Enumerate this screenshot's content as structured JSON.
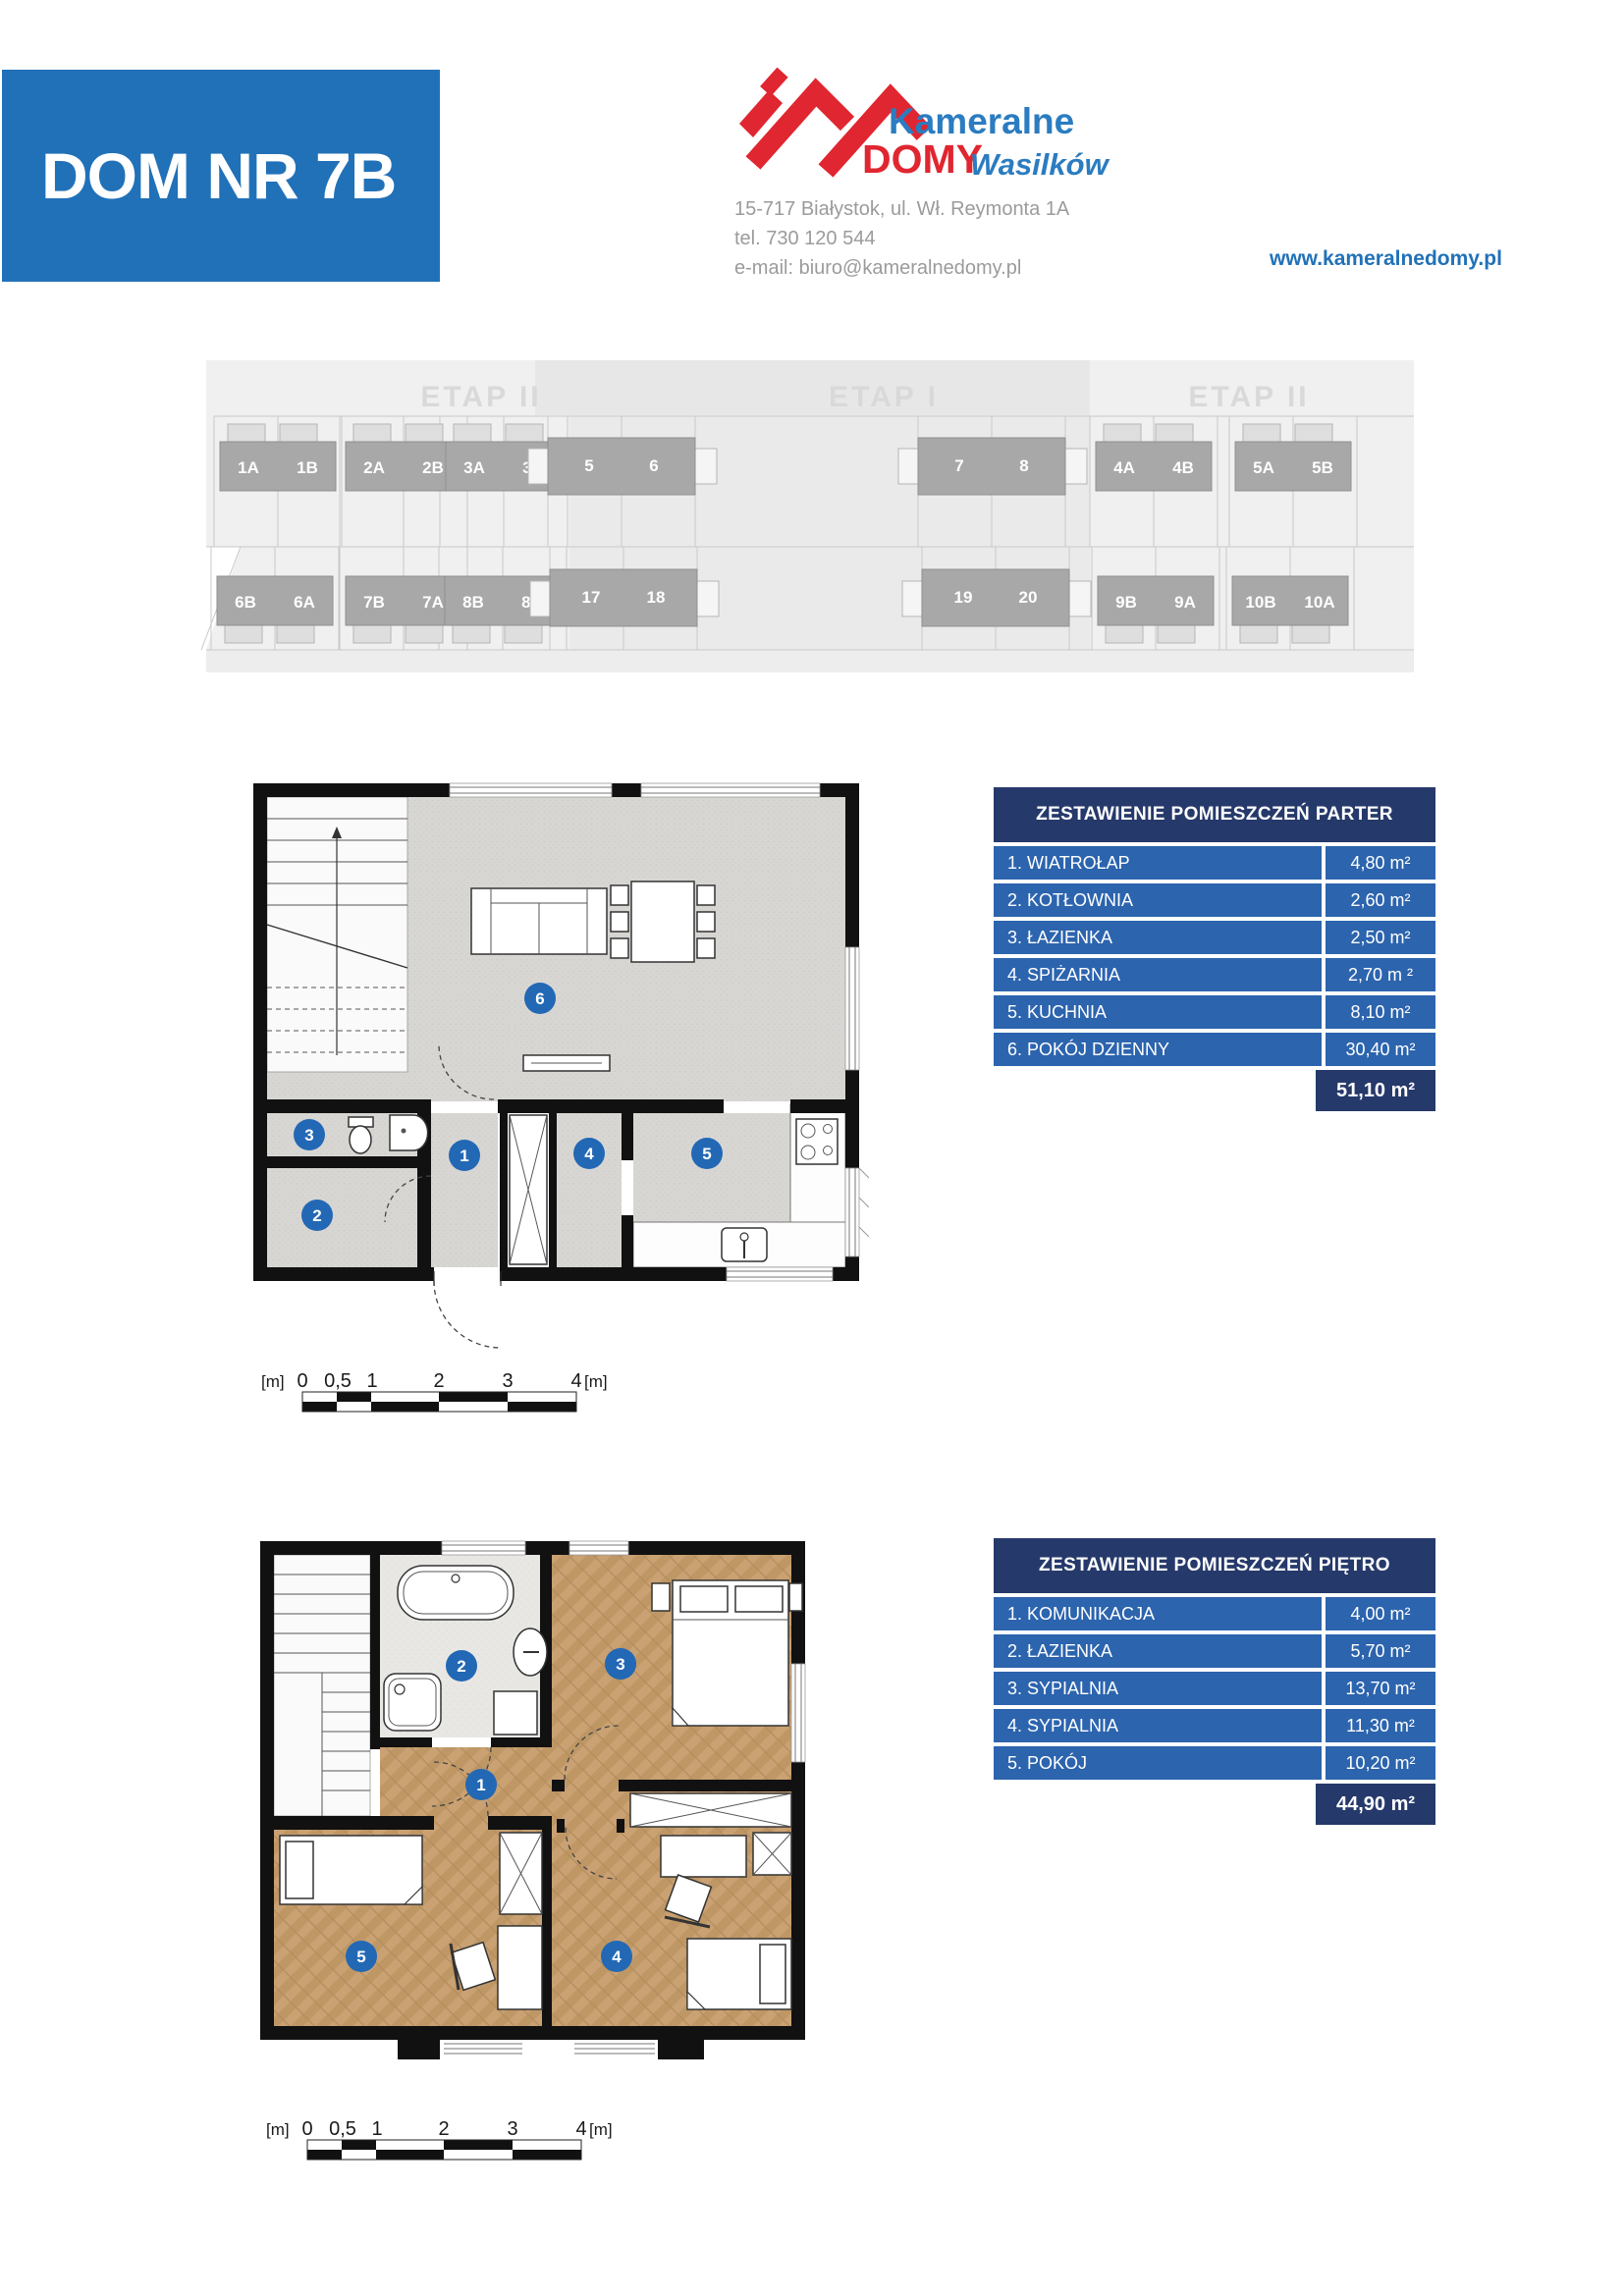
{
  "header": {
    "title": "DOM NR 7B",
    "logo": {
      "word1": "Kameralne",
      "word2": "DOMY",
      "word3": "Wasilków"
    },
    "address": "15-717 Białystok, ul. Wł. Reymonta 1A",
    "phone": "tel. 730 120 544",
    "email": "e-mail: biuro@kameralnedomy.pl",
    "website": "www.kameralnedomy.pl"
  },
  "site_plan": {
    "stages": [
      "ETAP II",
      "ETAP I",
      "ETAP II"
    ],
    "top_row": [
      [
        "1A",
        "1B"
      ],
      [
        "2A",
        "2B"
      ],
      [
        "3A",
        "3B"
      ],
      [
        "5",
        "6"
      ],
      [
        "7",
        "8"
      ],
      [
        "4A",
        "4B"
      ],
      [
        "5A",
        "5B"
      ]
    ],
    "bottom_row": [
      [
        "6B",
        "6A"
      ],
      [
        "7B",
        "7A"
      ],
      [
        "8B",
        "8A"
      ],
      [
        "17",
        "18"
      ],
      [
        "19",
        "20"
      ],
      [
        "9B",
        "9A"
      ],
      [
        "10B",
        "10A"
      ]
    ]
  },
  "plans": {
    "parter": {
      "rooms": [
        "1",
        "2",
        "3",
        "4",
        "5",
        "6"
      ]
    },
    "pietro": {
      "rooms": [
        "1",
        "2",
        "3",
        "4",
        "5"
      ]
    },
    "scale": {
      "left_unit": "[m]",
      "ticks": [
        "0",
        "0,5",
        "1",
        "2",
        "3",
        "4"
      ],
      "right_unit": "[m]"
    }
  },
  "tables": {
    "parter": {
      "title": "ZESTAWIENIE POMIESZCZEŃ PARTER",
      "rows": [
        {
          "label": "1. WIATROŁAP",
          "value": "4,80 m²"
        },
        {
          "label": "2. KOTŁOWNIA",
          "value": "2,60 m²"
        },
        {
          "label": "3. ŁAZIENKA",
          "value": "2,50 m²"
        },
        {
          "label": "4. SPIŻARNIA",
          "value": "2,70 m ²"
        },
        {
          "label": "5. KUCHNIA",
          "value": "8,10 m²"
        },
        {
          "label": "6. POKÓJ DZIENNY",
          "value": "30,40 m²"
        }
      ],
      "total": "51,10 m²"
    },
    "pietro": {
      "title": "ZESTAWIENIE POMIESZCZEŃ PIĘTRO",
      "rows": [
        {
          "label": "1. KOMUNIKACJA",
          "value": "4,00 m²"
        },
        {
          "label": "2. ŁAZIENKA",
          "value": "5,70 m²"
        },
        {
          "label": "3. SYPIALNIA",
          "value": "13,70 m²"
        },
        {
          "label": "4. SYPIALNIA",
          "value": "11,30 m²"
        },
        {
          "label": "5. POKÓJ",
          "value": "10,20 m²"
        }
      ],
      "total": "44,90 m²"
    }
  },
  "colors": {
    "banner_blue": "#2171b8",
    "table_header_navy": "#26396b",
    "table_row_blue": "#2c64ae",
    "logo_red": "#e02630",
    "room_circle_blue": "#2268b5"
  }
}
